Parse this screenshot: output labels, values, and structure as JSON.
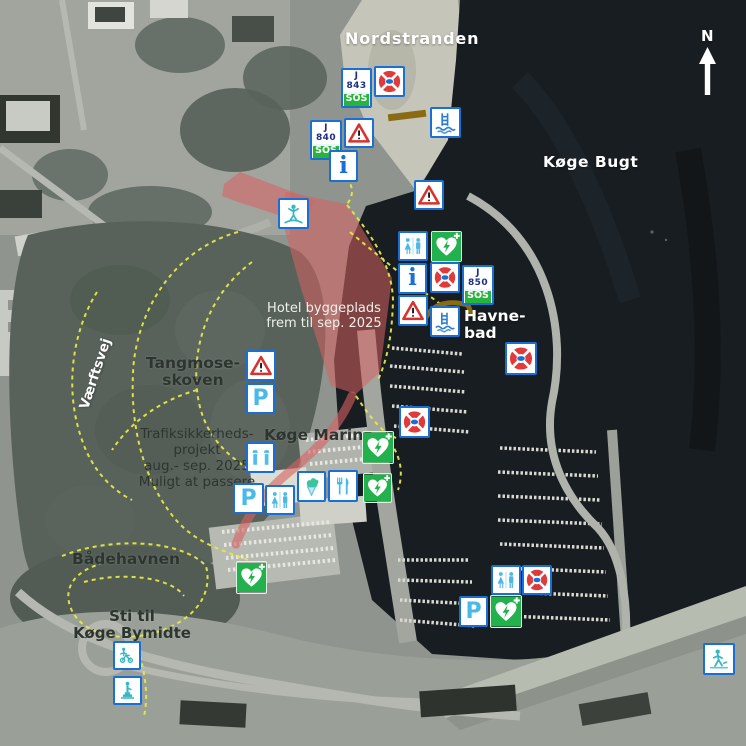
{
  "compass": {
    "label": "N"
  },
  "labels": {
    "nordstranden": "Nordstranden",
    "koge_bugt": "Køge Bugt",
    "havnebad": "Havne-\nbad",
    "tangmoseskoven": "Tangmose-\nskoven",
    "koge_marina": "Køge Marina",
    "badehavnen": "Bådehavnen",
    "sti_til_bymidte": "Sti til\nKøge Bymidte",
    "vaerftsvej": "Værftsvej"
  },
  "notes": {
    "hotel": "Hotel byggeplads\nfrem til sep. 2025",
    "traffic": "Trafiksikkerheds-\nprojekt\naug.- sep. 2025\nMuligt at passere"
  },
  "sos_signs": [
    {
      "code": "J 843",
      "label": "SOS"
    },
    {
      "code": "J 840",
      "label": "SOS"
    },
    {
      "code": "J 850",
      "label": "SOS"
    }
  ],
  "icons": {
    "parking_letter": "P",
    "info_letter": "i",
    "lifebuoy_center_text": "SOS",
    "types": [
      "lifebuoy-icon",
      "warning-icon",
      "info-icon",
      "toilet-icon",
      "defibrillator-icon",
      "parking-icon",
      "shower-icon",
      "ice-cream-icon",
      "restaurant-icon",
      "bathing-ladder-icon",
      "playground-icon",
      "statue-icon",
      "walking-icon",
      "sos-callpoint-sign",
      "north-arrow-icon"
    ]
  },
  "colors": {
    "marker_border_blue": "#1a6fd4",
    "defib_green": "#22b14c",
    "sos_green": "#28b43c",
    "lifebuoy_red": "#e03a3a",
    "warning_red": "#d8322f",
    "light_blue": "#49b9e8",
    "path_yellow": "#e3ea43",
    "construction_red": "#d96060"
  }
}
